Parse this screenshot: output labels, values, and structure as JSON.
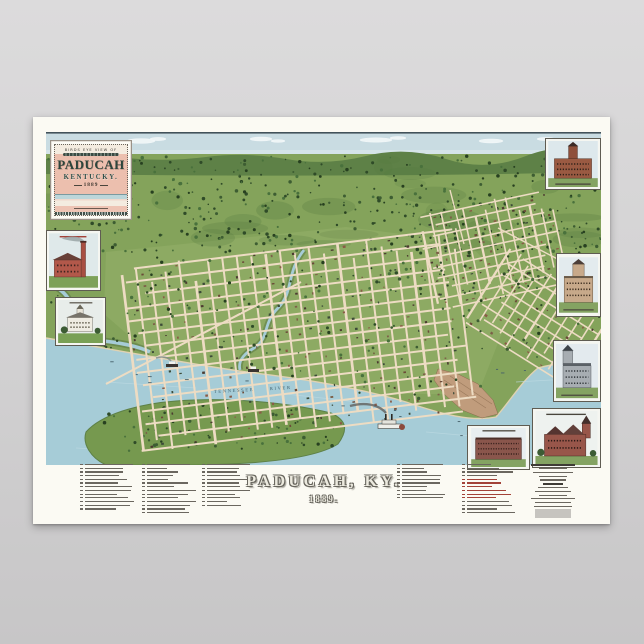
{
  "poster": {
    "background_top": "#dcdbdc",
    "background_bottom": "#c7c6c7",
    "paper_color": "#fbfaf3"
  },
  "cartouche": {
    "kicker": "BIRDS EYE VIEW OF",
    "title": "PADUCAH",
    "subtitle": "KENTUCKY.",
    "year": "1889"
  },
  "map": {
    "river_label": "TENNESSEE RIVER",
    "colors": {
      "sky": "#c9dce2",
      "land": "#84a35b",
      "ridge": "#5e8147",
      "trees": "#2f4b28",
      "water": "#a6ccd7",
      "street": "#eddcc3",
      "bluff": "#c09c7c",
      "accent_red": "#a34238"
    }
  },
  "title_block": {
    "city": "PADUCAH, KY.",
    "year": "1889."
  },
  "legend": {
    "columns": [
      {
        "rows": 13,
        "accent_rows": [],
        "heading_rows": []
      },
      {
        "rows": 14,
        "accent_rows": [],
        "heading_rows": []
      },
      {
        "rows": 12,
        "accent_rows": [],
        "heading_rows": []
      },
      {
        "rows": 10,
        "accent_rows": [],
        "heading_rows": []
      },
      {
        "rows": 14,
        "accent_rows": [
          4,
          5,
          6,
          7,
          8,
          9
        ],
        "heading_rows": []
      },
      {
        "rows": 12,
        "accent_rows": [],
        "heading_rows": [
          0,
          5
        ],
        "centered": true,
        "imprint_block": true
      }
    ]
  },
  "insets": [
    {
      "name": "brick-factory-with-smokestack"
    },
    {
      "name": "courthouse-with-cupola"
    },
    {
      "name": "brick-school-with-tower"
    },
    {
      "name": "three-story-building-with-mansard-tower"
    },
    {
      "name": "gray-building-with-corner-spire"
    },
    {
      "name": "victorian-mansion-with-turret"
    },
    {
      "name": "four-story-brick-block"
    }
  ]
}
